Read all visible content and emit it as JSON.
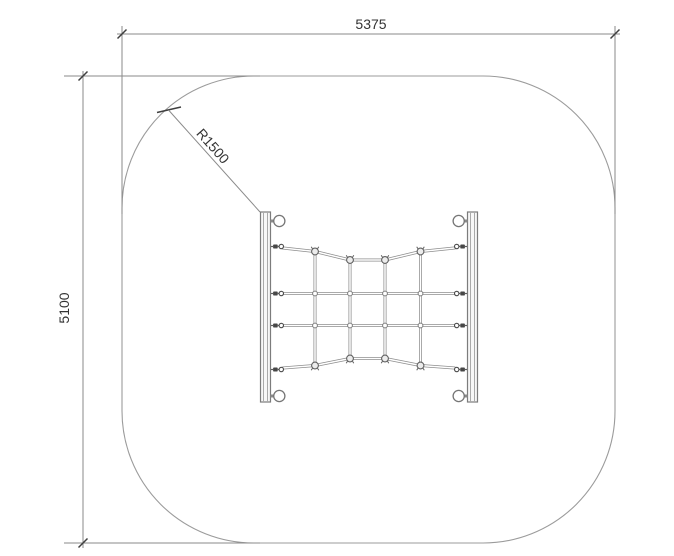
{
  "page": {
    "background": "#ffffff",
    "description": "CAD plan view of a climbing net between two posts inside a rounded-square safety area"
  },
  "drawing": {
    "colors": {
      "boundary_line": "#9b9b9b",
      "dimension_line": "#8a8a8a",
      "rope_line": "#8d8d8d",
      "text": "#333333"
    },
    "dimensions": {
      "width": {
        "label": "5375"
      },
      "height": {
        "label": "5100"
      },
      "corner_radius": {
        "label": "R1500"
      }
    }
  }
}
